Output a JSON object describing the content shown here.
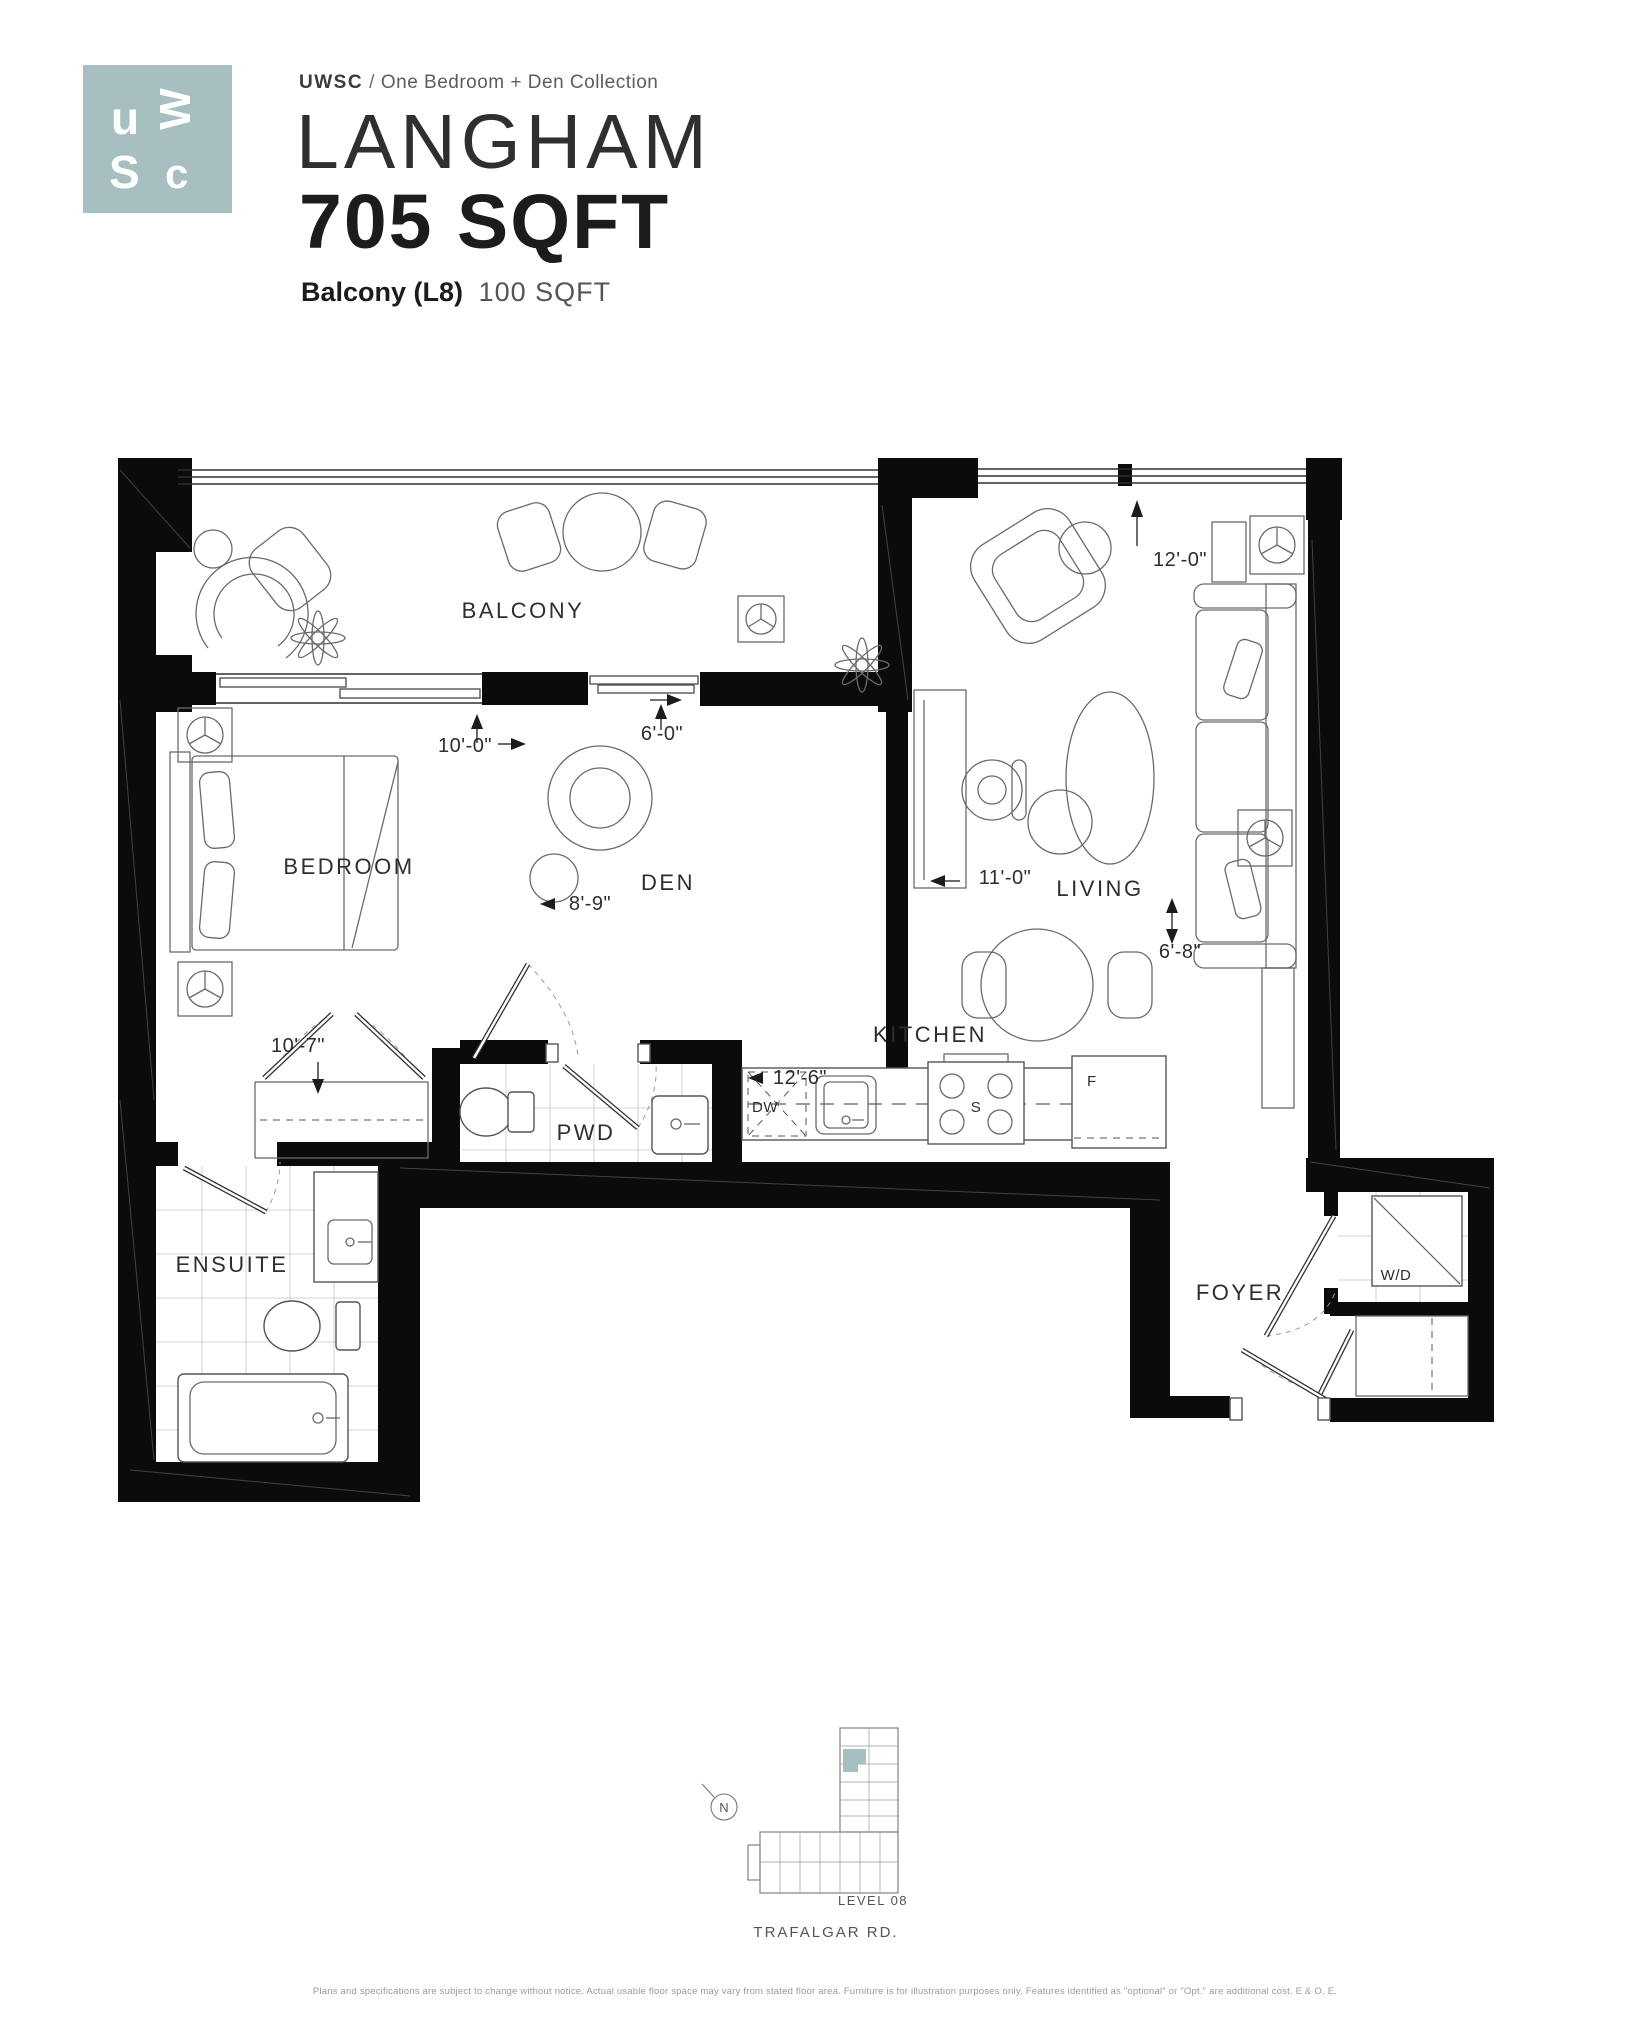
{
  "header": {
    "logo": {
      "letters": {
        "u": "u",
        "w": "W",
        "s": "S",
        "c": "c"
      }
    },
    "brand": "UWSC",
    "separator": "/",
    "collection": "One Bedroom + Den Collection",
    "plan_name": "LANGHAM",
    "plan_area": "705 SQFT",
    "balcony": {
      "label": "Balcony (L8)",
      "area": "100 SQFT"
    }
  },
  "plan": {
    "rooms": {
      "balcony": "BALCONY",
      "bedroom": "BEDROOM",
      "den": "DEN",
      "living": "LIVING",
      "kitchen": "KITCHEN",
      "pwd": "PWD",
      "ensuite": "ENSUITE",
      "foyer": "FOYER"
    },
    "fixtures": {
      "washer_dryer": "W/D",
      "dishwasher": "DW",
      "stove": "S",
      "fridge": "F"
    },
    "dimensions": {
      "living_width": "12'-0\"",
      "bedroom_width": "10'-0\"",
      "den_window": "6'-0\"",
      "living_depth": "11'-0\"",
      "den_width": "8'-9\"",
      "living_side": "6'-8\"",
      "bedroom_depth": "10'-7\"",
      "kitchen_run": "12'-6\""
    }
  },
  "keyplan": {
    "north": "N",
    "level": "LEVEL 08",
    "street": "TRAFALGAR RD."
  },
  "footer": {
    "disclaimer": "Plans and specifications are subject to change without notice. Actual usable floor space may vary from stated floor area. Furniture is for illustration purposes only. Features identified as \"optional\" or \"Opt.\" are additional cost. E & O. E."
  },
  "colors": {
    "accent": "#a7bfc0",
    "wall": "#0b0b0b"
  }
}
